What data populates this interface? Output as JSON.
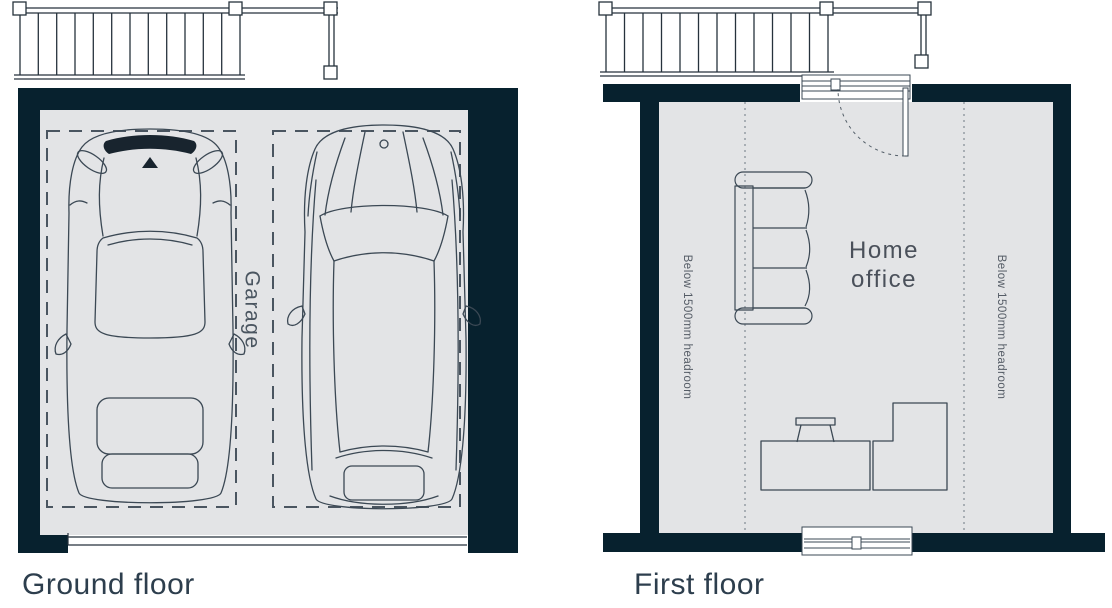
{
  "plans": {
    "ground": {
      "title": "Ground floor",
      "room_label": "Garage"
    },
    "first": {
      "title": "First floor",
      "room_label_line1": "Home",
      "room_label_line2": "office",
      "headroom_left": "Below 1500mm headroom",
      "headroom_right": "Below 1500mm headroom"
    }
  },
  "colors": {
    "wall": "#07212e",
    "floor": "#e3e4e6",
    "drawing_line": "#3b4854",
    "stair_line": "#26323c",
    "label_text": "#4a5560",
    "title_text": "#2d3e4d",
    "dashed_parking": "#4a5560",
    "dotted_guide": "#9aa1a8"
  }
}
